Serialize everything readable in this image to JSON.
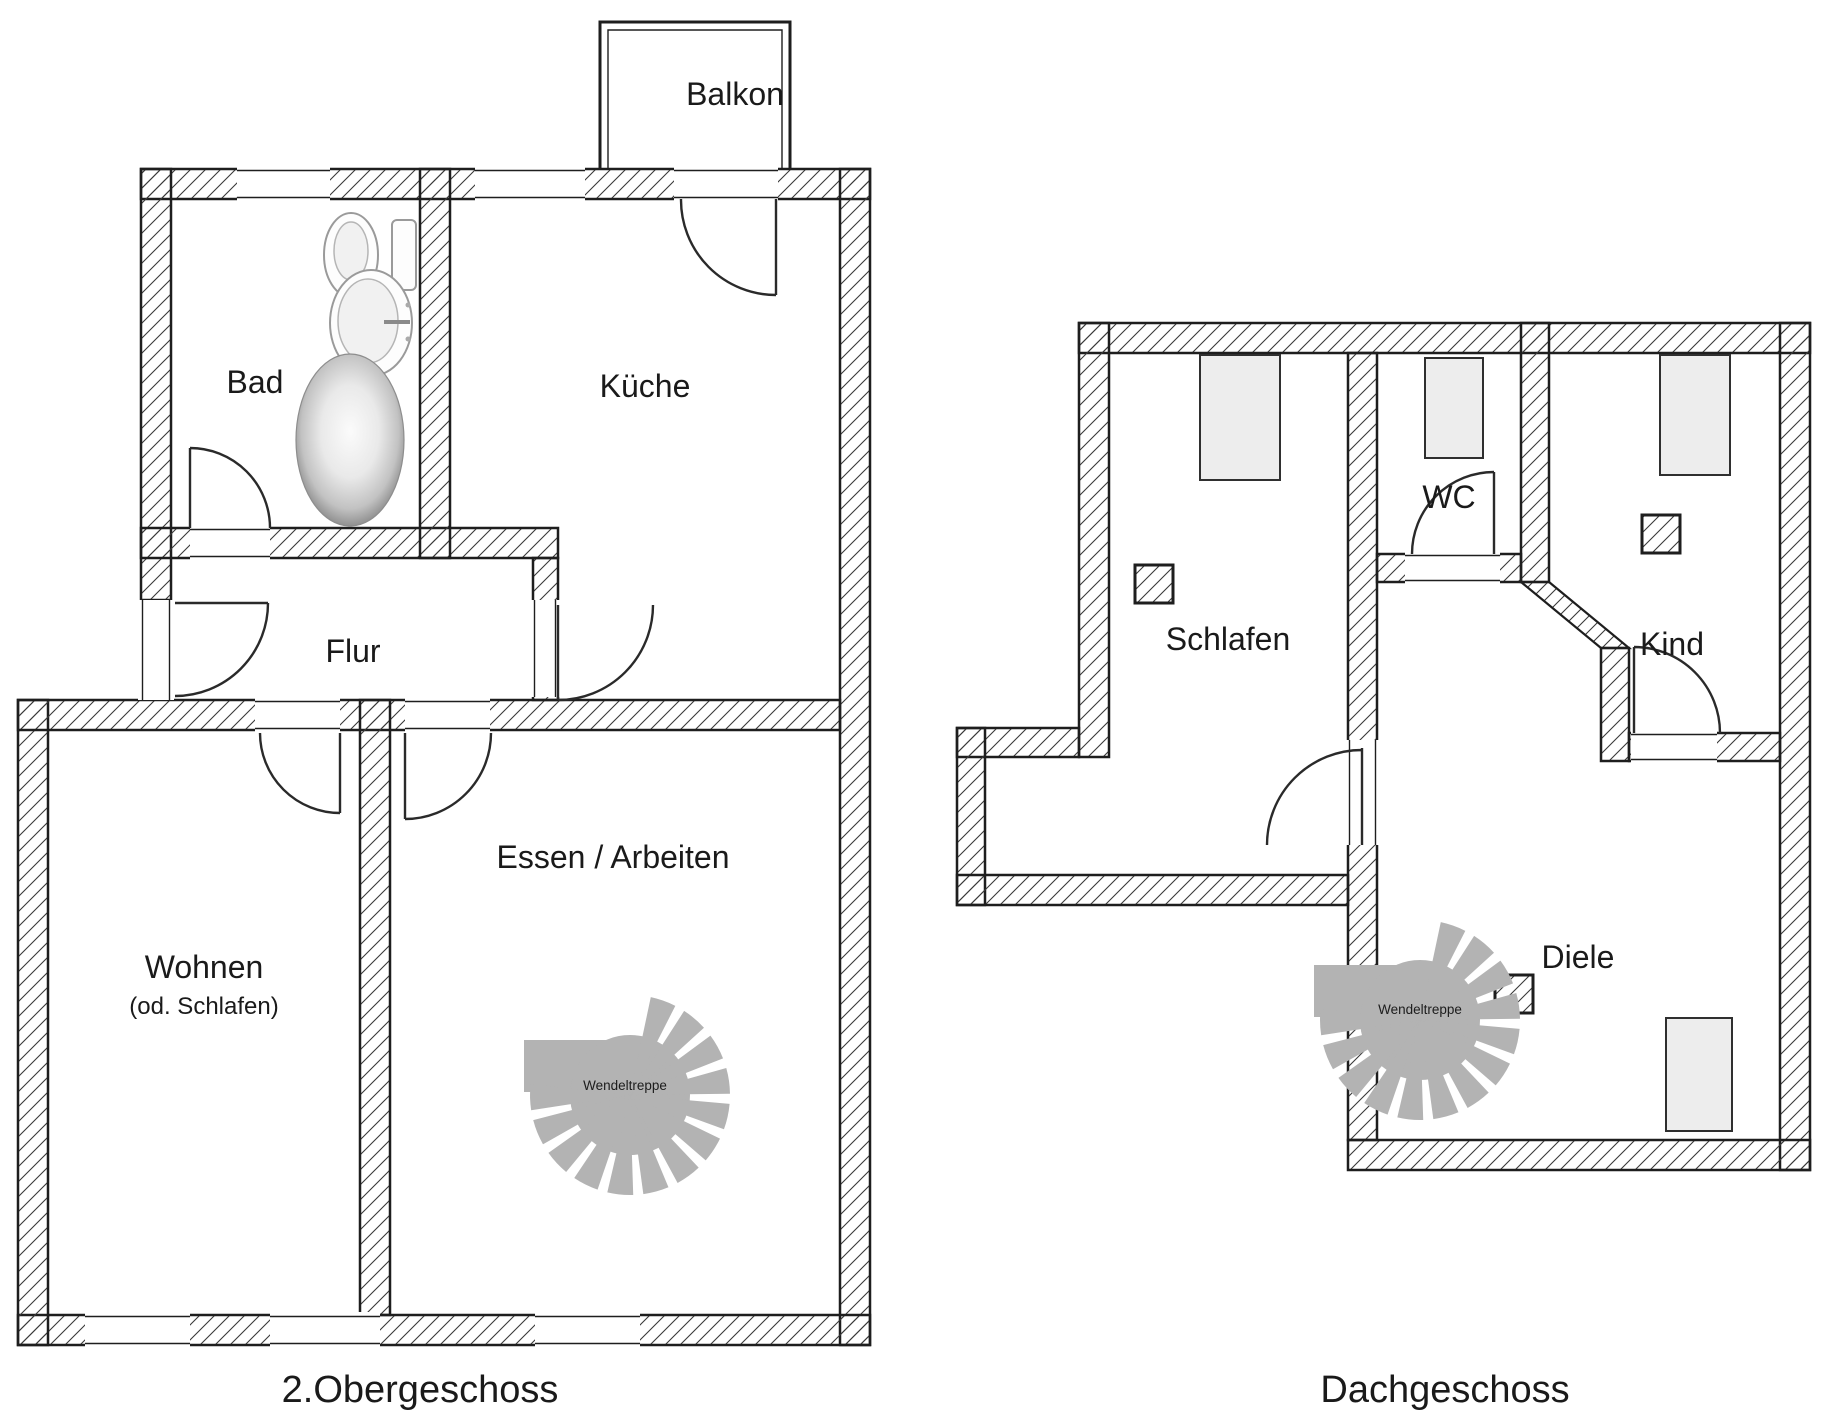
{
  "plans": {
    "og": {
      "caption": "2.Obergeschoss",
      "rooms": {
        "balkon": "Balkon",
        "bad": "Bad",
        "kueche": "Küche",
        "flur": "Flur",
        "wohnen": "Wohnen",
        "wohnen_alt": "(od. Schlafen)",
        "essen": "Essen / Arbeiten",
        "wendeltreppe": "Wendeltreppe"
      }
    },
    "dg": {
      "caption": "Dachgeschoss",
      "rooms": {
        "schlafen": "Schlafen",
        "wc": "WC",
        "kind": "Kind",
        "diele": "Diele",
        "wendeltreppe": "Wendeltreppe"
      }
    }
  },
  "icons": {
    "spiral_staircase": "spiral-staircase-icon",
    "toilet": "toilet-icon",
    "sink": "sink-icon",
    "bathtub": "bathtub-icon",
    "door_swing": "door-swing-arc",
    "window": "window-opening",
    "skylight": "skylight",
    "chimney": "chimney-icon"
  },
  "colors": {
    "wall_line": "#1e1e1e",
    "hatch_line": "#3a3a3a",
    "stair_gray": "#b3b3b3",
    "skylight_fill": "#ededed",
    "fixture_gray": "#9a9a9a",
    "background": "#ffffff"
  }
}
